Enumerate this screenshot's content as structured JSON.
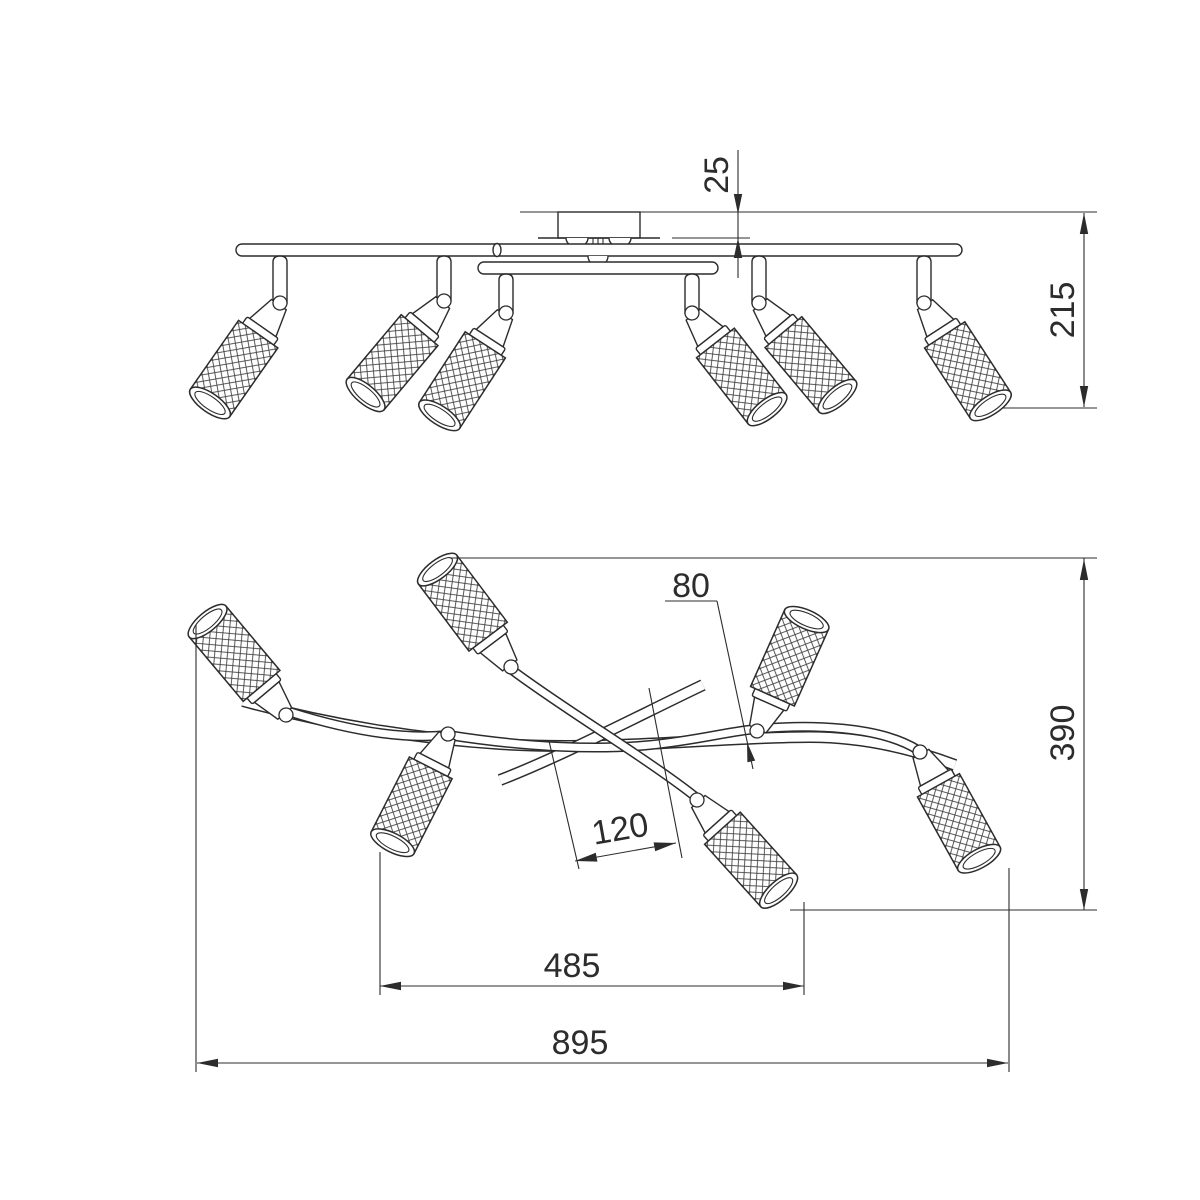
{
  "page": {
    "background": "#ffffff",
    "line_color": "#2c2c2c"
  },
  "drawing": {
    "kind": "technical dimension drawing",
    "subject": "six-lamp ceiling spot fixture with mesh cylindrical shades",
    "views": [
      {
        "id": "side-view",
        "lamps": 6,
        "dimensions": [
          {
            "name": "ceiling-offset",
            "value": "25"
          },
          {
            "name": "overall-height",
            "value": "215"
          }
        ]
      },
      {
        "id": "plan-view",
        "lamps": 6,
        "dimensions": [
          {
            "name": "swivel-leader",
            "value": "80"
          },
          {
            "name": "overall-depth",
            "value": "390"
          },
          {
            "name": "center-offset",
            "value": "120"
          },
          {
            "name": "inner-span",
            "value": "485"
          },
          {
            "name": "overall-width",
            "value": "895"
          }
        ]
      }
    ]
  }
}
